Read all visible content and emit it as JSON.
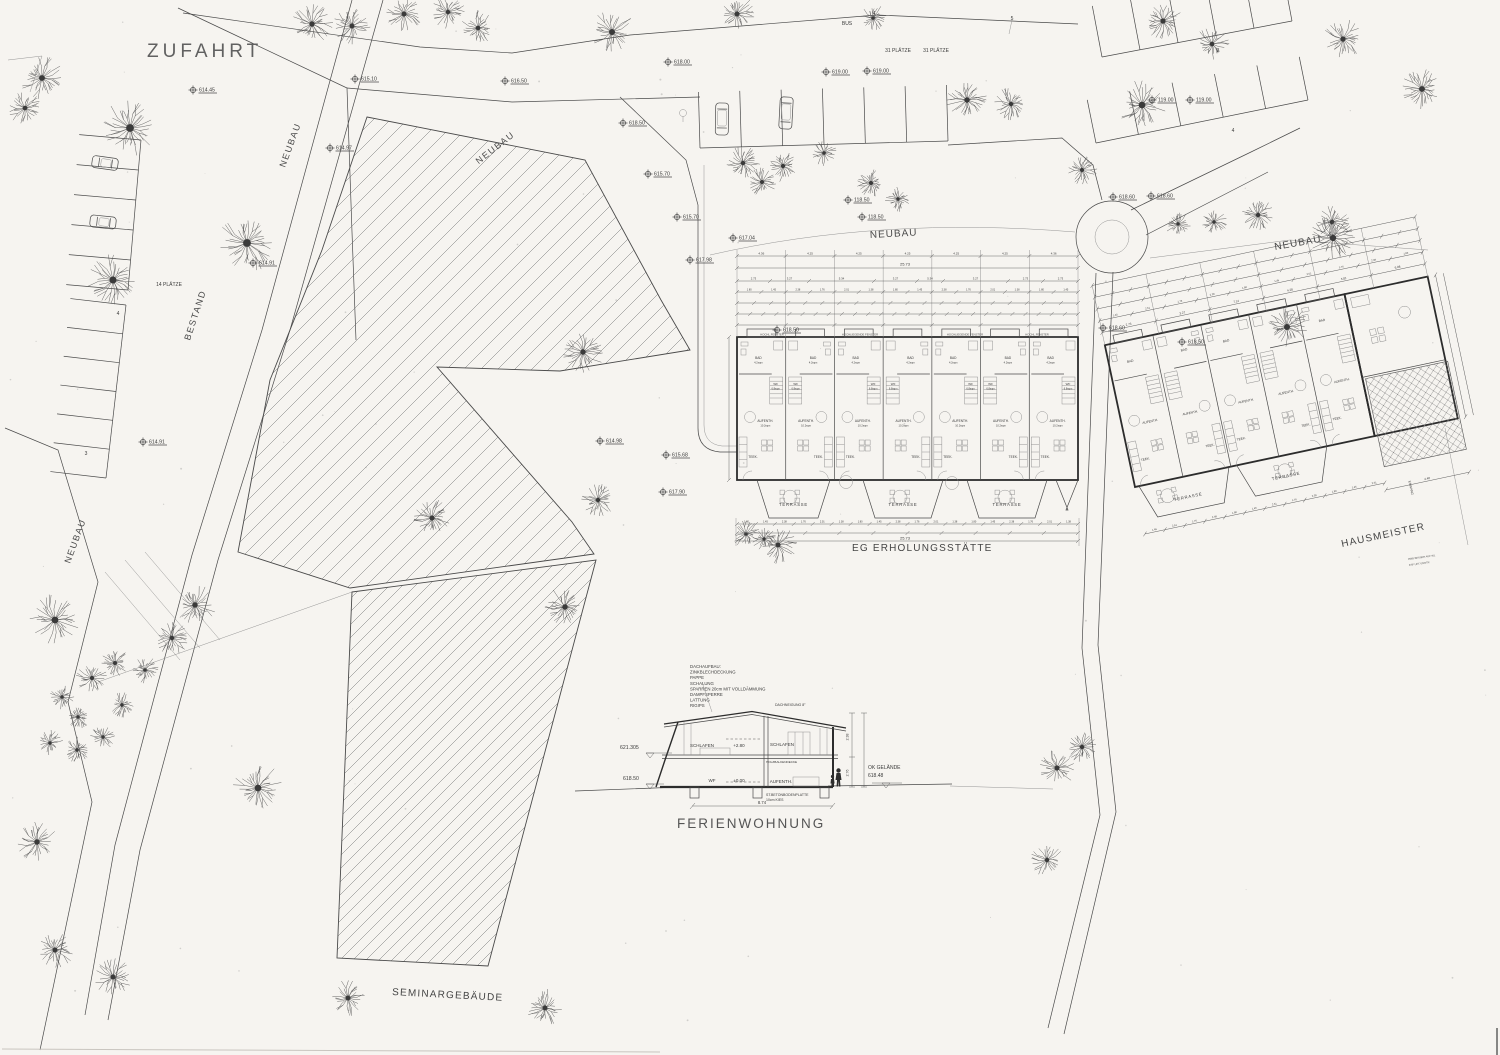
{
  "sheet": {
    "paper": "#f6f4f0",
    "ink": "#3b3b3b",
    "line": "#4a4a4a",
    "hatch": "#6f6f6f"
  },
  "labels": {
    "zufahrt": "ZUFAHRT",
    "bus": "BUS",
    "plaetze31_a": "31 PLÄTZE",
    "plaetze31_b": "31 PLÄTZE",
    "plaetze14": "14 PLÄTZE",
    "bestand": "BESTAND",
    "neubau_road_upper": "NEUBAU",
    "neubau_road_left": "NEUBAU",
    "neubau_seminar": "NEUBAU",
    "neubau_center": "NEUBAU",
    "neubau_right": "NEUBAU",
    "seminargebaeude": "SEMINARGEBÄUDE",
    "eg_erholungsstaette": "EG ERHOLUNGSSTÄTTE",
    "hausmeister": "HAUSMEISTER",
    "ferienwohnung": "FERIENWOHNUNG",
    "eingang": "EINGANG",
    "margin_note_1": "HWB BESSER AUF WL",
    "margin_note_2": "KSF UKT UMSTR",
    "stall_no_3a": "3",
    "stall_no_4a": "4",
    "stall_no_4b": "4",
    "stall_no_5": "5",
    "stall_no_3b": "3",
    "stall_no_4c": "4"
  },
  "elevation_markers": [
    {
      "x": 193,
      "y": 90,
      "v": "614.45"
    },
    {
      "x": 355,
      "y": 79,
      "v": "615.10"
    },
    {
      "x": 505,
      "y": 81,
      "v": "616.50"
    },
    {
      "x": 668,
      "y": 62,
      "v": "618.00"
    },
    {
      "x": 826,
      "y": 72,
      "v": "619.00"
    },
    {
      "x": 867,
      "y": 71,
      "v": "619.00"
    },
    {
      "x": 1152,
      "y": 100,
      "v": "119.00"
    },
    {
      "x": 1190,
      "y": 100,
      "v": "119.00"
    },
    {
      "x": 330,
      "y": 148,
      "v": "614.97"
    },
    {
      "x": 623,
      "y": 123,
      "v": "618.50"
    },
    {
      "x": 648,
      "y": 174,
      "v": "615.70"
    },
    {
      "x": 677,
      "y": 217,
      "v": "615.70"
    },
    {
      "x": 733,
      "y": 238,
      "v": "617.04"
    },
    {
      "x": 690,
      "y": 260,
      "v": "617.98"
    },
    {
      "x": 253,
      "y": 263,
      "v": "614.91"
    },
    {
      "x": 143,
      "y": 442,
      "v": "614.91"
    },
    {
      "x": 600,
      "y": 441,
      "v": "614.98"
    },
    {
      "x": 666,
      "y": 455,
      "v": "615.68"
    },
    {
      "x": 663,
      "y": 492,
      "v": "617.90"
    },
    {
      "x": 848,
      "y": 200,
      "v": "118.50"
    },
    {
      "x": 862,
      "y": 217,
      "v": "118.50"
    },
    {
      "x": 1113,
      "y": 197,
      "v": "618.60"
    },
    {
      "x": 1151,
      "y": 196,
      "v": "618.60"
    },
    {
      "x": 777,
      "y": 330,
      "v": "618.50"
    },
    {
      "x": 1103,
      "y": 328,
      "v": "618.60"
    },
    {
      "x": 1182,
      "y": 342,
      "v": "618.50"
    }
  ],
  "section": {
    "notes": [
      "DACHAUFBAU:",
      "ZINKBLECHDECKUNG",
      "PAPPE",
      "SCHALUNG",
      "SPARREN 20cm MIT VOLLDÄMMUNG",
      "DAMPFSPERRE",
      "LATTUNG",
      "RIGIPS"
    ],
    "roof_pitch": "DACHNEIGUNG 8°",
    "rooms": {
      "schlafen_l": "SCHLAFEN",
      "schlafen_r": "SCHLAFEN",
      "wf": "WF",
      "aufenth": "AUFENTH."
    },
    "levels": {
      "upper": "+2.80",
      "ground": "±0.00",
      "left_top": "621.305",
      "left_ground": "618.50",
      "right_label": "OK GELÄNDE",
      "right_value": "618.48"
    },
    "materials": {
      "ceiling": "HOLZBALKENDECKE",
      "slab": "ST.BETONBODENPLATTE",
      "gravel": "10cm KIES"
    },
    "dims": {
      "h_upper": "2.38",
      "h_lower": "2.76",
      "width": "8.74"
    }
  },
  "central_building": {
    "units": 7,
    "window_label_short": "HOCHL.FENSTER",
    "window_label_full": "HOCHLIEGENDE FENSTER",
    "terrasse": "TERRASSE",
    "room": {
      "bad": "BAD",
      "bad_area": "4.2sqm",
      "wf": "WF",
      "wf_area": "6.8sqm",
      "aufenth": "AUFENTH.",
      "aufenth_area": "10.2sqm",
      "teek": "TEEK."
    },
    "total": "25.73",
    "upper_dims": [
      "4.36",
      "4.25",
      "4.25",
      "4.25",
      "4.25",
      "4.25",
      "4.36"
    ],
    "mid_dims": [
      "2.73",
      "3.27",
      "5.34",
      "3.27",
      "5.34",
      "3.27",
      "2.73"
    ],
    "tick_dims": [
      "1.80",
      "1.45",
      "2.38",
      "1.76",
      "2.01",
      "1.38"
    ]
  },
  "right_building": {
    "units": 5,
    "terrasse": "TERRASSE",
    "room": {
      "bad": "BAD",
      "aufenth": "AUFENTH.",
      "teek": "TEEK."
    },
    "upper_dims": [
      "2.73",
      "3.27",
      "7.14",
      "4.28",
      "5.01",
      "6.08"
    ],
    "tick_dims": [
      "1.45",
      "2.51",
      "1.76",
      "2.38",
      "1.80"
    ]
  },
  "trees": [
    [
      42,
      78,
      22
    ],
    [
      25,
      108,
      18
    ],
    [
      130,
      128,
      30
    ],
    [
      113,
      280,
      27
    ],
    [
      247,
      243,
      30
    ],
    [
      312,
      24,
      21
    ],
    [
      352,
      26,
      19
    ],
    [
      404,
      14,
      19
    ],
    [
      448,
      12,
      17
    ],
    [
      478,
      28,
      18
    ],
    [
      612,
      32,
      23
    ],
    [
      737,
      14,
      19
    ],
    [
      873,
      18,
      14
    ],
    [
      967,
      100,
      21
    ],
    [
      1011,
      104,
      17
    ],
    [
      1142,
      105,
      25
    ],
    [
      1163,
      21,
      20
    ],
    [
      1212,
      44,
      18
    ],
    [
      1343,
      39,
      20
    ],
    [
      1422,
      89,
      22
    ],
    [
      1082,
      170,
      15
    ],
    [
      1178,
      224,
      13
    ],
    [
      1214,
      222,
      13
    ],
    [
      1258,
      215,
      17
    ],
    [
      1332,
      222,
      18
    ],
    [
      1333,
      238,
      24
    ],
    [
      1287,
      327,
      23
    ],
    [
      743,
      163,
      17
    ],
    [
      762,
      182,
      15
    ],
    [
      783,
      166,
      16
    ],
    [
      824,
      153,
      14
    ],
    [
      871,
      183,
      15
    ],
    [
      898,
      199,
      13
    ],
    [
      583,
      352,
      21
    ],
    [
      432,
      518,
      19
    ],
    [
      598,
      500,
      17
    ],
    [
      565,
      607,
      21
    ],
    [
      778,
      545,
      19
    ],
    [
      746,
      534,
      14
    ],
    [
      764,
      539,
      12
    ],
    [
      195,
      605,
      21
    ],
    [
      172,
      638,
      17
    ],
    [
      55,
      620,
      26
    ],
    [
      92,
      678,
      16
    ],
    [
      115,
      663,
      15
    ],
    [
      145,
      670,
      14
    ],
    [
      62,
      697,
      13
    ],
    [
      78,
      717,
      13
    ],
    [
      50,
      743,
      13
    ],
    [
      77,
      750,
      13
    ],
    [
      103,
      737,
      13
    ],
    [
      122,
      705,
      13
    ],
    [
      37,
      842,
      21
    ],
    [
      258,
      788,
      25
    ],
    [
      55,
      950,
      19
    ],
    [
      113,
      977,
      19
    ],
    [
      348,
      998,
      19
    ],
    [
      545,
      1008,
      19
    ],
    [
      1057,
      768,
      19
    ],
    [
      1082,
      747,
      17
    ],
    [
      1047,
      860,
      17
    ]
  ],
  "cars": [
    {
      "x": 105,
      "y": 163,
      "rot": -82,
      "kind": "car"
    },
    {
      "x": 103,
      "y": 222,
      "rot": -84,
      "kind": "car"
    },
    {
      "x": 722,
      "y": 119,
      "rot": 181,
      "kind": "van"
    },
    {
      "x": 786,
      "y": 113,
      "rot": 183,
      "kind": "van"
    }
  ],
  "speckle_count": 90
}
